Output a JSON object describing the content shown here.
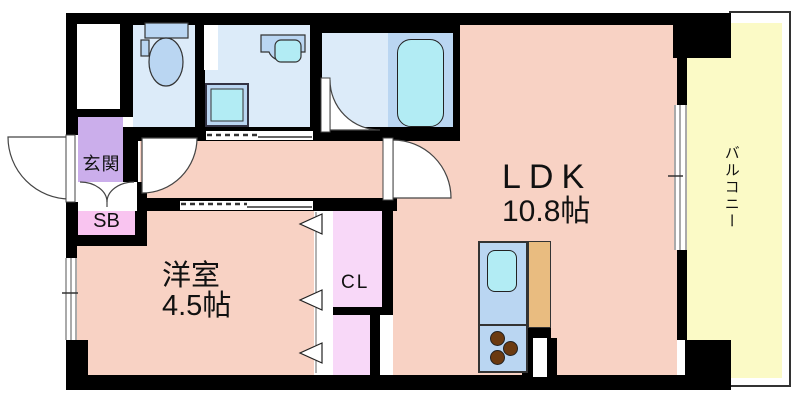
{
  "plan": {
    "rooms": {
      "entrance": {
        "label": "玄関"
      },
      "shoe_box": {
        "label": "SB"
      },
      "western_room": {
        "name": "洋室",
        "size": "4.5帖"
      },
      "closet": {
        "label": "CL"
      },
      "ldk": {
        "name": "LDK",
        "size": "10.8帖"
      },
      "balcony": {
        "label": "バルコニー"
      }
    },
    "colors": {
      "wall": "#000000",
      "floor": "#f8d2c4",
      "wet_area": "#dcebf9",
      "fixture": "#bad6f2",
      "water": "#b2ecf4",
      "entrance": "#cbaeeb",
      "shoe_box": "#f9c4f0",
      "closet": "#f8d8f8",
      "balcony": "#fbfac6",
      "counter": "#e9bc80",
      "burner": "#6b3a10"
    }
  }
}
